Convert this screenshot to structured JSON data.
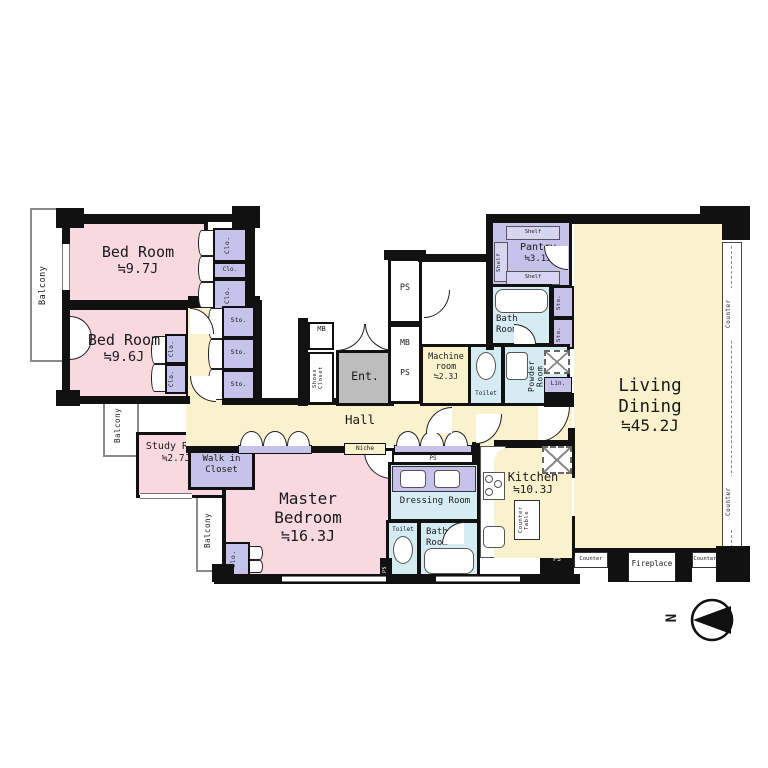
{
  "t": {
    "bed1": "Bed Room",
    "bed1s": "≒9.7J",
    "bed2": "Bed Room",
    "bed2s": "≒9.6J",
    "study": "Study Room",
    "studys": "≒2.7J",
    "master": "Master Bedroom",
    "masters": "≒16.3J",
    "living": "Living Dining",
    "livings": "≒45.2J",
    "kitchen": "Kitchen",
    "kitchens": "≒10.3J",
    "pantry": "Pantry",
    "pantrys": "≒3.1J",
    "machine": "Machine room",
    "machines": "≒2.3J",
    "hall": "Hall",
    "ent": "Ent.",
    "niche": "Niche",
    "walkin": "Walk in Closet",
    "shoes": "Shoes Closet",
    "bath": "Bath Room",
    "powder": "Powder Room",
    "dressing": "Dressing Room",
    "toilet": "Toilet",
    "lin": "Lin.",
    "mb": "MB",
    "ps": "PS",
    "clo": "Clo.",
    "sto": "Sto.",
    "shelf": "Shelf",
    "balcony": "Balcony",
    "counter": "Counter",
    "countertable": "Counter Table",
    "fireplace": "Fireplace",
    "north": "N"
  },
  "colors": {
    "room_pink": "#f8d8e1",
    "closet_purple": "#c6c2e9",
    "shelf_purple": "#d8d5f2",
    "floor_cream": "#f9f2cc",
    "wet_blue": "#d4ecf2",
    "entrance_gray": "#bdbdbd",
    "wall": "#111111"
  }
}
